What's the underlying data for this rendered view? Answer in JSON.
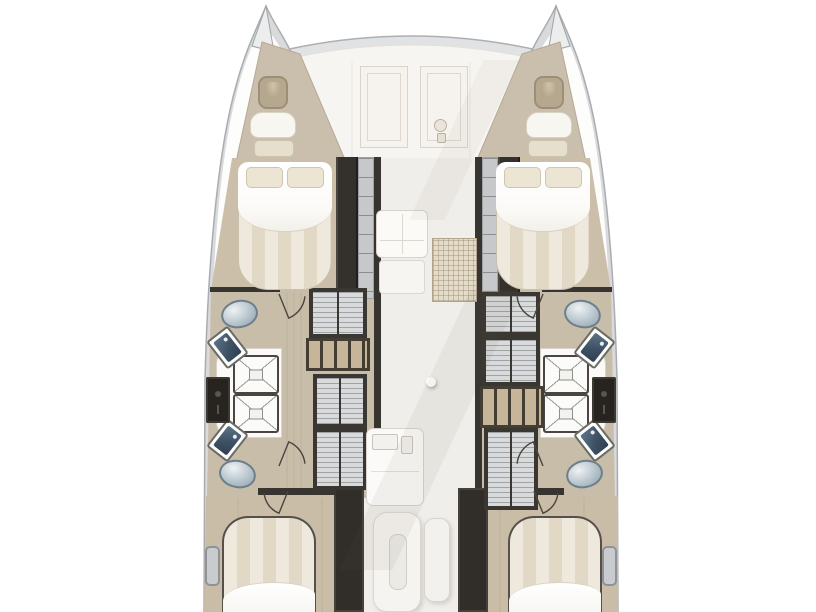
{
  "meta": {
    "description": "Top-down deck floor plan of a sailing catamaran: two hulls with forepeak berths, two forward island double beds, four bathrooms with showers, toilets and sinks, slatted lockers along the corridor, central salon with couch, galley, island and bench, and two aft double beds (cut off at image bottom). No text labels are visible.",
    "view": "deck-plan",
    "vessel_type": "catamaran"
  },
  "palette": {
    "background": "#ffffff",
    "hull_shell": "#d8dadc",
    "hull_stroke": "#a9adb0",
    "deck_white": "#f7f5f1",
    "wood_floor": "#cbbfa9",
    "wood_floor_mid": "#c8bda9",
    "dark_wall": "#38342f",
    "slat_fill": "#d9dadb",
    "shelf_wood": "#c6b598",
    "bed_stripe_a": "#efe9dd",
    "bed_stripe_b": "#e1d8c6",
    "toilet_blue": "#8da1ae",
    "sink_basin": "#3e5164",
    "salon_floor": "#f0eeea",
    "grid_mat": "#e4dbca"
  },
  "icons": [
    {
      "name": "windlass-icon"
    },
    {
      "name": "deck-hatch"
    },
    {
      "name": "door-swing-arc"
    }
  ],
  "fixtures": [
    {
      "type": "wardrobe",
      "name": "port-wardrobe",
      "x": 336,
      "y": 157,
      "w": 22,
      "h": 142
    },
    {
      "type": "stairs",
      "name": "port-companionway-stairs",
      "x": 358,
      "y": 157,
      "w": 16,
      "h": 142
    },
    {
      "type": "wall",
      "name": "port-corridor-wall",
      "x": 374,
      "y": 157,
      "w": 7,
      "h": 348
    },
    {
      "type": "wall",
      "name": "stbd-corridor-wall",
      "x": 475,
      "y": 157,
      "w": 7,
      "h": 348
    },
    {
      "type": "stairs",
      "name": "stbd-companionway-stairs",
      "x": 482,
      "y": 157,
      "w": 16,
      "h": 142
    },
    {
      "type": "wardrobe",
      "name": "stbd-wardrobe",
      "x": 498,
      "y": 157,
      "w": 22,
      "h": 142
    },
    {
      "type": "wall",
      "name": "port-bath-fwd-wall",
      "x": 210,
      "y": 287,
      "w": 70,
      "h": 5
    },
    {
      "type": "wall",
      "name": "stbd-bath-fwd-wall",
      "x": 542,
      "y": 287,
      "w": 70,
      "h": 5
    },
    {
      "type": "bulkhead",
      "name": "port-aft-bulkhead",
      "x": 334,
      "y": 488,
      "w": 30,
      "h": 124
    },
    {
      "type": "bulkhead",
      "name": "stbd-aft-bulkhead",
      "x": 458,
      "y": 488,
      "w": 30,
      "h": 124
    },
    {
      "type": "wall",
      "name": "port-aft-cabin-wall",
      "x": 258,
      "y": 488,
      "w": 78,
      "h": 7
    },
    {
      "type": "wall",
      "name": "stbd-aft-cabin-wall",
      "x": 486,
      "y": 488,
      "w": 78,
      "h": 7
    },
    {
      "type": "platform_l",
      "name": "port-shower-platform",
      "x": 216,
      "y": 348,
      "w": 66,
      "h": 90
    },
    {
      "type": "platform_r",
      "name": "stbd-shower-platform",
      "x": 540,
      "y": 348,
      "w": 66,
      "h": 90
    },
    {
      "type": "shower",
      "name": "port-shower-fwd",
      "x": 233,
      "y": 355,
      "w": 46,
      "h": 39
    },
    {
      "type": "shower",
      "name": "port-shower-aft",
      "x": 233,
      "y": 394,
      "w": 46,
      "h": 39
    },
    {
      "type": "shower",
      "name": "stbd-shower-fwd",
      "x": 543,
      "y": 355,
      "w": 46,
      "h": 39
    },
    {
      "type": "shower",
      "name": "stbd-shower-aft",
      "x": 543,
      "y": 394,
      "w": 46,
      "h": 39
    },
    {
      "type": "toilet",
      "name": "port-toilet-fwd",
      "x": 221,
      "y": 300,
      "w": 37,
      "h": 28,
      "rot": -12
    },
    {
      "type": "toilet",
      "name": "port-toilet-aft",
      "x": 219,
      "y": 460,
      "w": 37,
      "h": 28,
      "rot": 12
    },
    {
      "type": "toilet",
      "name": "stbd-toilet-fwd",
      "x": 564,
      "y": 300,
      "w": 37,
      "h": 28,
      "rot": 12
    },
    {
      "type": "toilet",
      "name": "stbd-toilet-aft",
      "x": 566,
      "y": 460,
      "w": 37,
      "h": 28,
      "rot": -12
    },
    {
      "type": "sink",
      "name": "port-sink-fwd",
      "x": 214,
      "y": 330,
      "w": 27,
      "h": 35,
      "rot": -38
    },
    {
      "type": "sink",
      "name": "port-sink-aft",
      "x": 214,
      "y": 423,
      "w": 27,
      "h": 35,
      "rot": 38
    },
    {
      "type": "sink",
      "name": "stbd-sink-fwd",
      "x": 581,
      "y": 330,
      "w": 27,
      "h": 35,
      "rot": 38
    },
    {
      "type": "sink",
      "name": "stbd-sink-aft",
      "x": 581,
      "y": 423,
      "w": 27,
      "h": 35,
      "rot": -38
    },
    {
      "type": "vanity",
      "name": "port-vanity-cabinet",
      "x": 206,
      "y": 377,
      "w": 24,
      "h": 46
    },
    {
      "type": "vanity",
      "name": "stbd-vanity-cabinet",
      "x": 592,
      "y": 377,
      "w": 24,
      "h": 46
    },
    {
      "type": "slatted",
      "name": "port-slatted-locker-1",
      "x": 309,
      "y": 288,
      "w": 58,
      "h": 50
    },
    {
      "type": "shelf",
      "name": "port-step-shelf",
      "x": 306,
      "y": 338,
      "w": 64,
      "h": 33
    },
    {
      "type": "slatted",
      "name": "port-slatted-locker-2",
      "x": 313,
      "y": 374,
      "w": 54,
      "h": 54
    },
    {
      "type": "slatted",
      "name": "port-slatted-locker-3",
      "x": 313,
      "y": 428,
      "w": 54,
      "h": 62
    },
    {
      "type": "slatted",
      "name": "stbd-slatted-locker-1",
      "x": 482,
      "y": 292,
      "w": 58,
      "h": 44
    },
    {
      "type": "slatted",
      "name": "stbd-slatted-locker-2",
      "x": 482,
      "y": 336,
      "w": 58,
      "h": 50
    },
    {
      "type": "shelf",
      "name": "stbd-step-shelf",
      "x": 480,
      "y": 386,
      "w": 64,
      "h": 42
    },
    {
      "type": "slatted",
      "name": "stbd-slatted-locker-3",
      "x": 484,
      "y": 428,
      "w": 54,
      "h": 82
    },
    {
      "type": "bed_fwd",
      "name": "port-forward-double-bed",
      "x": 238,
      "y": 162,
      "w": 94,
      "h": 128
    },
    {
      "type": "pillow",
      "name": "port-fwd-pillow-1",
      "x": 246,
      "y": 167,
      "w": 37,
      "h": 21
    },
    {
      "type": "pillow",
      "name": "port-fwd-pillow-2",
      "x": 287,
      "y": 167,
      "w": 37,
      "h": 21
    },
    {
      "type": "bed_fwd",
      "name": "stbd-forward-double-bed",
      "x": 496,
      "y": 162,
      "w": 94,
      "h": 128
    },
    {
      "type": "pillow",
      "name": "stbd-fwd-pillow-1",
      "x": 504,
      "y": 167,
      "w": 37,
      "h": 21
    },
    {
      "type": "pillow",
      "name": "stbd-fwd-pillow-2",
      "x": 545,
      "y": 167,
      "w": 37,
      "h": 21
    },
    {
      "type": "bed_aft",
      "name": "port-aft-double-bed",
      "x": 222,
      "y": 516,
      "w": 94,
      "h": 98
    },
    {
      "type": "bed_aft",
      "name": "stbd-aft-double-bed",
      "x": 508,
      "y": 516,
      "w": 94,
      "h": 98
    },
    {
      "type": "fp_hatch",
      "name": "port-forepeak-hatch",
      "x": 258,
      "y": 76,
      "w": 30,
      "h": 33
    },
    {
      "type": "fp_cushion",
      "name": "port-forepeak-cushion",
      "x": 250,
      "y": 112,
      "w": 46,
      "h": 26
    },
    {
      "type": "fp_pillow",
      "name": "port-forepeak-pillow",
      "x": 254,
      "y": 140,
      "w": 40,
      "h": 17
    },
    {
      "type": "fp_hatch",
      "name": "stbd-forepeak-hatch",
      "x": 534,
      "y": 76,
      "w": 30,
      "h": 33
    },
    {
      "type": "fp_cushion",
      "name": "stbd-forepeak-cushion",
      "x": 526,
      "y": 112,
      "w": 46,
      "h": 26
    },
    {
      "type": "fp_pillow",
      "name": "stbd-forepeak-pillow",
      "x": 528,
      "y": 140,
      "w": 40,
      "h": 17
    },
    {
      "type": "deck_hatch",
      "name": "foredeck-hatch-port",
      "x": 360,
      "y": 66,
      "w": 48,
      "h": 82
    },
    {
      "type": "deck_hatch",
      "name": "foredeck-hatch-stbd",
      "x": 420,
      "y": 66,
      "w": 48,
      "h": 82
    },
    {
      "type": "couch",
      "name": "salon-couch",
      "x": 376,
      "y": 210,
      "w": 52,
      "h": 48
    },
    {
      "type": "couch_ext",
      "name": "salon-couch-extension",
      "x": 379,
      "y": 260,
      "w": 46,
      "h": 34
    },
    {
      "type": "gridmat",
      "name": "galley-grid-mat",
      "x": 432,
      "y": 238,
      "w": 45,
      "h": 64
    },
    {
      "type": "post",
      "name": "mast-post",
      "x": 426,
      "y": 377,
      "w": 10,
      "h": 10
    },
    {
      "type": "galley",
      "name": "galley-counter",
      "x": 366,
      "y": 428,
      "w": 58,
      "h": 78
    },
    {
      "type": "gsink",
      "name": "galley-sink",
      "x": 372,
      "y": 434,
      "w": 26,
      "h": 16
    },
    {
      "type": "gsink",
      "name": "galley-sink-small",
      "x": 401,
      "y": 436,
      "w": 12,
      "h": 18
    },
    {
      "type": "island",
      "name": "galley-island",
      "x": 373,
      "y": 512,
      "w": 48,
      "h": 100
    },
    {
      "type": "ipill",
      "name": "galley-island-sink",
      "x": 389,
      "y": 534,
      "w": 18,
      "h": 56
    },
    {
      "type": "bench",
      "name": "salon-bench",
      "x": 424,
      "y": 518,
      "w": 26,
      "h": 84
    },
    {
      "type": "sidewin",
      "name": "port-side-locker",
      "x": 205,
      "y": 546,
      "w": 15,
      "h": 40
    },
    {
      "type": "sidewin",
      "name": "stbd-side-locker",
      "x": 602,
      "y": 546,
      "w": 15,
      "h": 40
    }
  ],
  "door_arcs": [
    {
      "name": "port-bath-fwd-door",
      "x": 279,
      "y": 294,
      "r": 26,
      "a0": 5,
      "a1": 68
    },
    {
      "name": "port-bath-aft-door",
      "x": 279,
      "y": 466,
      "r": 26,
      "a0": -5,
      "a1": -68
    },
    {
      "name": "port-aft-cabin-door",
      "x": 288,
      "y": 491,
      "r": 24,
      "a0": 175,
      "a1": 112
    },
    {
      "name": "stbd-bath-fwd-door",
      "x": 543,
      "y": 294,
      "r": 26,
      "a0": 175,
      "a1": 112
    },
    {
      "name": "stbd-bath-aft-door",
      "x": 543,
      "y": 466,
      "r": 26,
      "a0": 185,
      "a1": 248
    },
    {
      "name": "stbd-aft-cabin-door",
      "x": 534,
      "y": 491,
      "r": 24,
      "a0": 5,
      "a1": 68
    }
  ]
}
